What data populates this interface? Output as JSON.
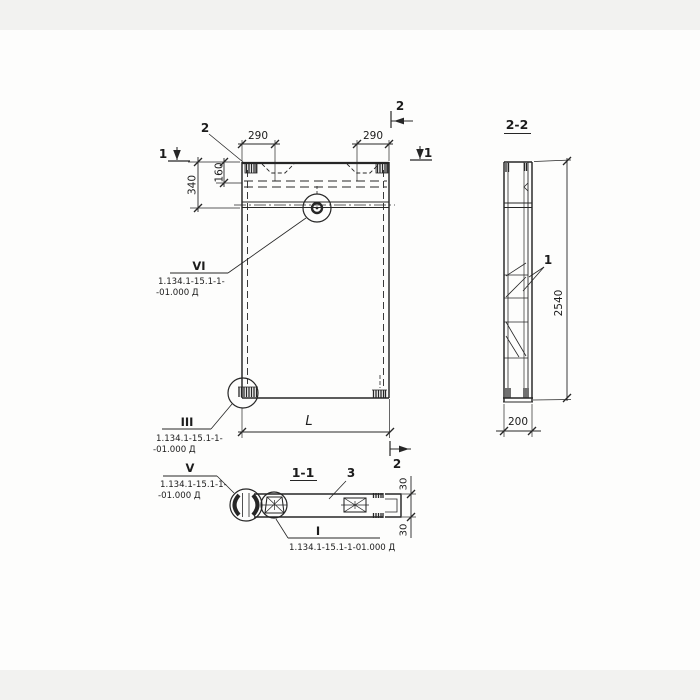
{
  "front_view": {
    "callout_top_embed": "2",
    "cut_mark_left": "1",
    "cut_mark_right": "1",
    "cut_mark_top": "2",
    "cut_mark_bottom": "2",
    "dim_290_left": "290",
    "dim_290_right": "290",
    "dim_340": "340",
    "dim_160": "160",
    "dim_length": "L",
    "detail_vi": {
      "label": "VI",
      "doc_line1": "1.134.1-15.1-1-",
      "doc_line2": "-01.000 Д"
    },
    "detail_iii": {
      "label": "III",
      "doc_line1": "1.134.1-15.1-1-",
      "doc_line2": "-01.000 Д"
    }
  },
  "section_2_2": {
    "title": "2-2",
    "callout_rib": "1",
    "dim_height": "2540",
    "dim_width": "200"
  },
  "section_1_1": {
    "title": "1-1",
    "callout_slab": "3",
    "dim_30_top": "30",
    "dim_30_bottom": "30",
    "detail_v": {
      "label": "V",
      "doc_line1": "1.134.1-15.1-1-",
      "doc_line2": "-01.000 Д"
    },
    "detail_i": {
      "label": "I",
      "doc": "1.134.1-15.1-1-01.000 Д"
    }
  }
}
